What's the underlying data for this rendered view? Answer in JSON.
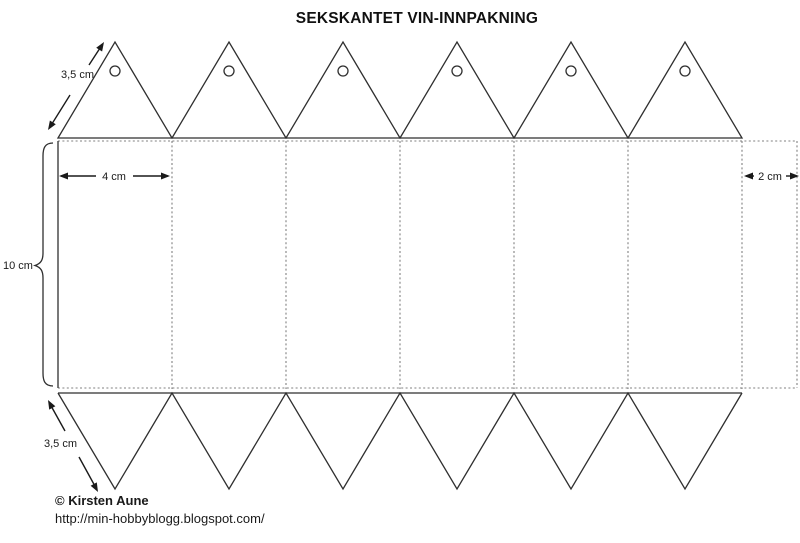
{
  "title": "SEKSKANTET VIN-INNPAKNING",
  "dimensions": {
    "top_flap_side": "3,5 cm",
    "panel_width": "4 cm",
    "glue_flap_width": "2 cm",
    "body_height": "10 cm",
    "bottom_flap_side": "3,5 cm"
  },
  "footer": {
    "copyright": "© Kirsten Aune",
    "url": "http://min-hobbyblogg.blogspot.com/"
  },
  "colors": {
    "solid_line": "#2f2f2f",
    "dashed_fold_line": "#808080",
    "text": "#1a1a1a",
    "background": "#ffffff"
  }
}
